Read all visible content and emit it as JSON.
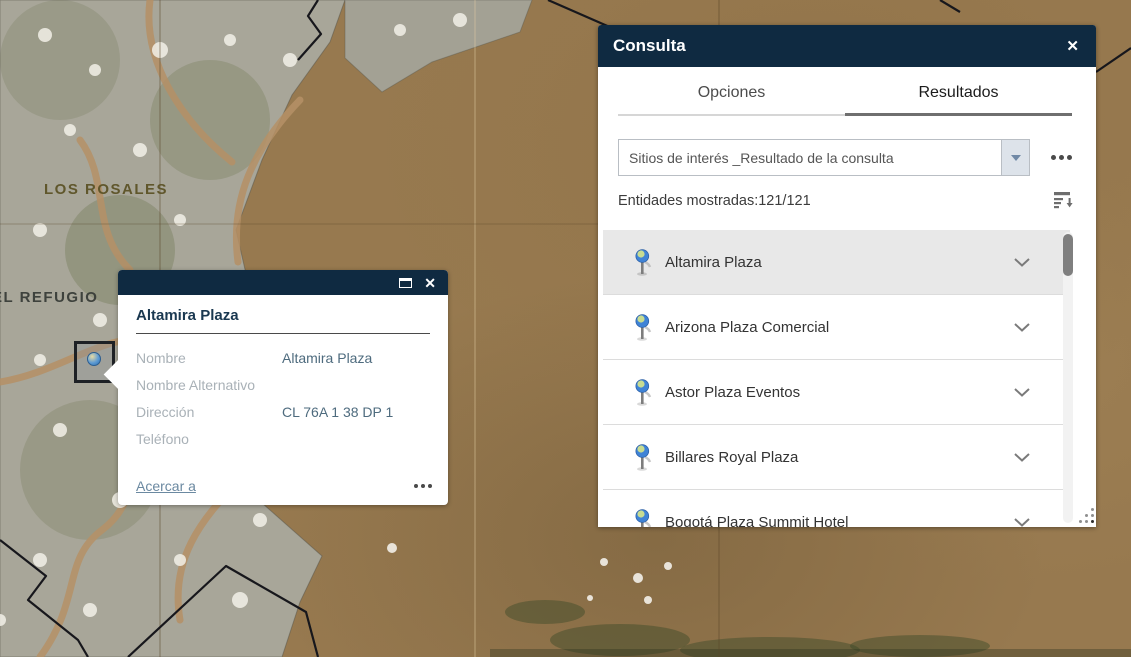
{
  "colors": {
    "header_bg": "#0f2a41",
    "selected_row": "#e8e8e8",
    "link": "#6b89a1",
    "map_terrain": "#97794f",
    "tab_active_underline": "#6f6f6f"
  },
  "icons": {
    "panel_close": "✕",
    "popup_close": "✕",
    "popup_maximize": "maximize-square",
    "more_options": "three-dots",
    "sort": "list-sort-descending",
    "result_pin": "blue-pushpin",
    "row_expand": "chevron-down",
    "layer_dropdown": "chevron-down-triangle"
  },
  "map": {
    "labels": [
      {
        "text": "LOS ROSALES"
      },
      {
        "text": "EL REFUGIO"
      }
    ]
  },
  "panel": {
    "title": "Consulta",
    "tabs": [
      {
        "label": "Opciones",
        "active": false
      },
      {
        "label": "Resultados",
        "active": true
      }
    ],
    "layer_select": {
      "value": "Sitios de interés _Resultado de la consulta"
    },
    "entities_text": "Entidades mostradas:121/121",
    "results": [
      {
        "name": "Altamira Plaza",
        "selected": true
      },
      {
        "name": "Arizona Plaza Comercial",
        "selected": false
      },
      {
        "name": "Astor Plaza Eventos",
        "selected": false
      },
      {
        "name": "Billares Royal Plaza",
        "selected": false
      },
      {
        "name": "Bogotá Plaza Summit Hotel",
        "selected": false
      }
    ]
  },
  "popup": {
    "title": "Altamira Plaza",
    "fields": [
      {
        "label": "Nombre",
        "value": "Altamira Plaza"
      },
      {
        "label": "Nombre Alternativo",
        "value": ""
      },
      {
        "label": "Dirección",
        "value": "CL 76A 1 38 DP 1"
      },
      {
        "label": "Teléfono",
        "value": ""
      }
    ],
    "zoom_link": "Acercar a"
  }
}
